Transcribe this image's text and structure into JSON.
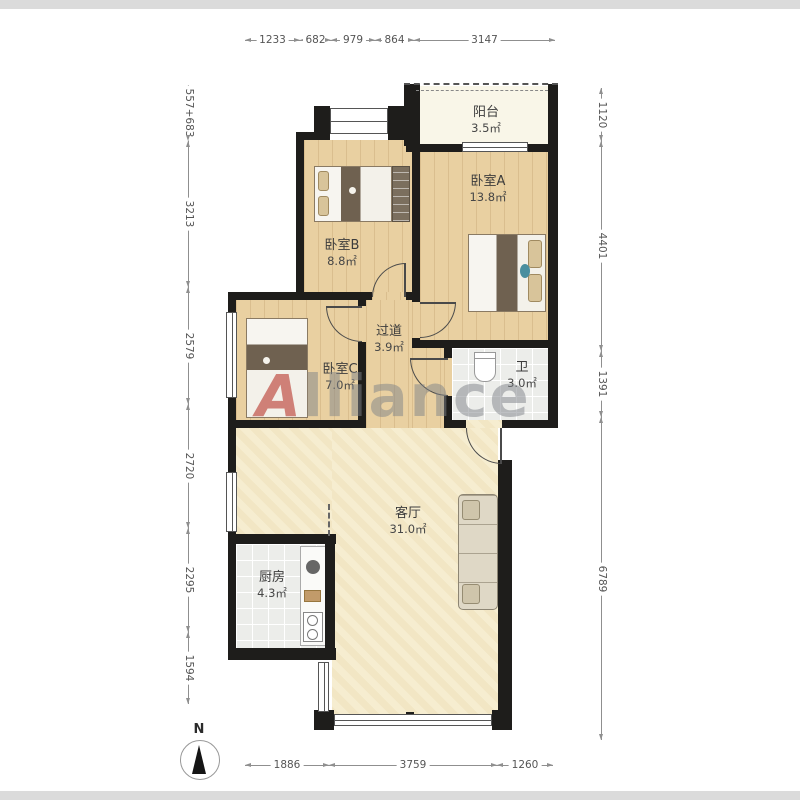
{
  "watermark": {
    "first": "A",
    "rest": "lliance"
  },
  "compass": {
    "label": "N"
  },
  "rooms": {
    "balcony": {
      "name": "阳台",
      "area": "3.5㎡"
    },
    "bedroomA": {
      "name": "卧室A",
      "area": "13.8㎡"
    },
    "bedroomB": {
      "name": "卧室B",
      "area": "8.8㎡"
    },
    "bedroomC": {
      "name": "卧室C",
      "area": "7.0㎡"
    },
    "hallway": {
      "name": "过道",
      "area": "3.9㎡"
    },
    "bathroom": {
      "name": "卫",
      "area": "3.0㎡"
    },
    "living": {
      "name": "客厅",
      "area": "31.0㎡"
    },
    "kitchen": {
      "name": "厨房",
      "area": "4.3㎡"
    }
  },
  "dimensions": {
    "top": [
      "1233",
      "682",
      "979",
      "864",
      "3147"
    ],
    "left": [
      "557+683",
      "3213",
      "2579",
      "2720",
      "2295",
      "1594"
    ],
    "right": [
      "1120",
      "4401",
      "1391",
      "6789"
    ],
    "bottom": [
      "1886",
      "3759",
      "1260"
    ]
  },
  "colors": {
    "wall": "#1e1d1b",
    "wood_floor": "#e9d0a1",
    "living_floor": "#f6edd0",
    "tile_floor": "#ecedea",
    "balcony_floor": "#f9f6e8",
    "dimension_line": "#8f8f8f",
    "watermark_gray": "#7d8288",
    "watermark_red": "#b7352a"
  }
}
